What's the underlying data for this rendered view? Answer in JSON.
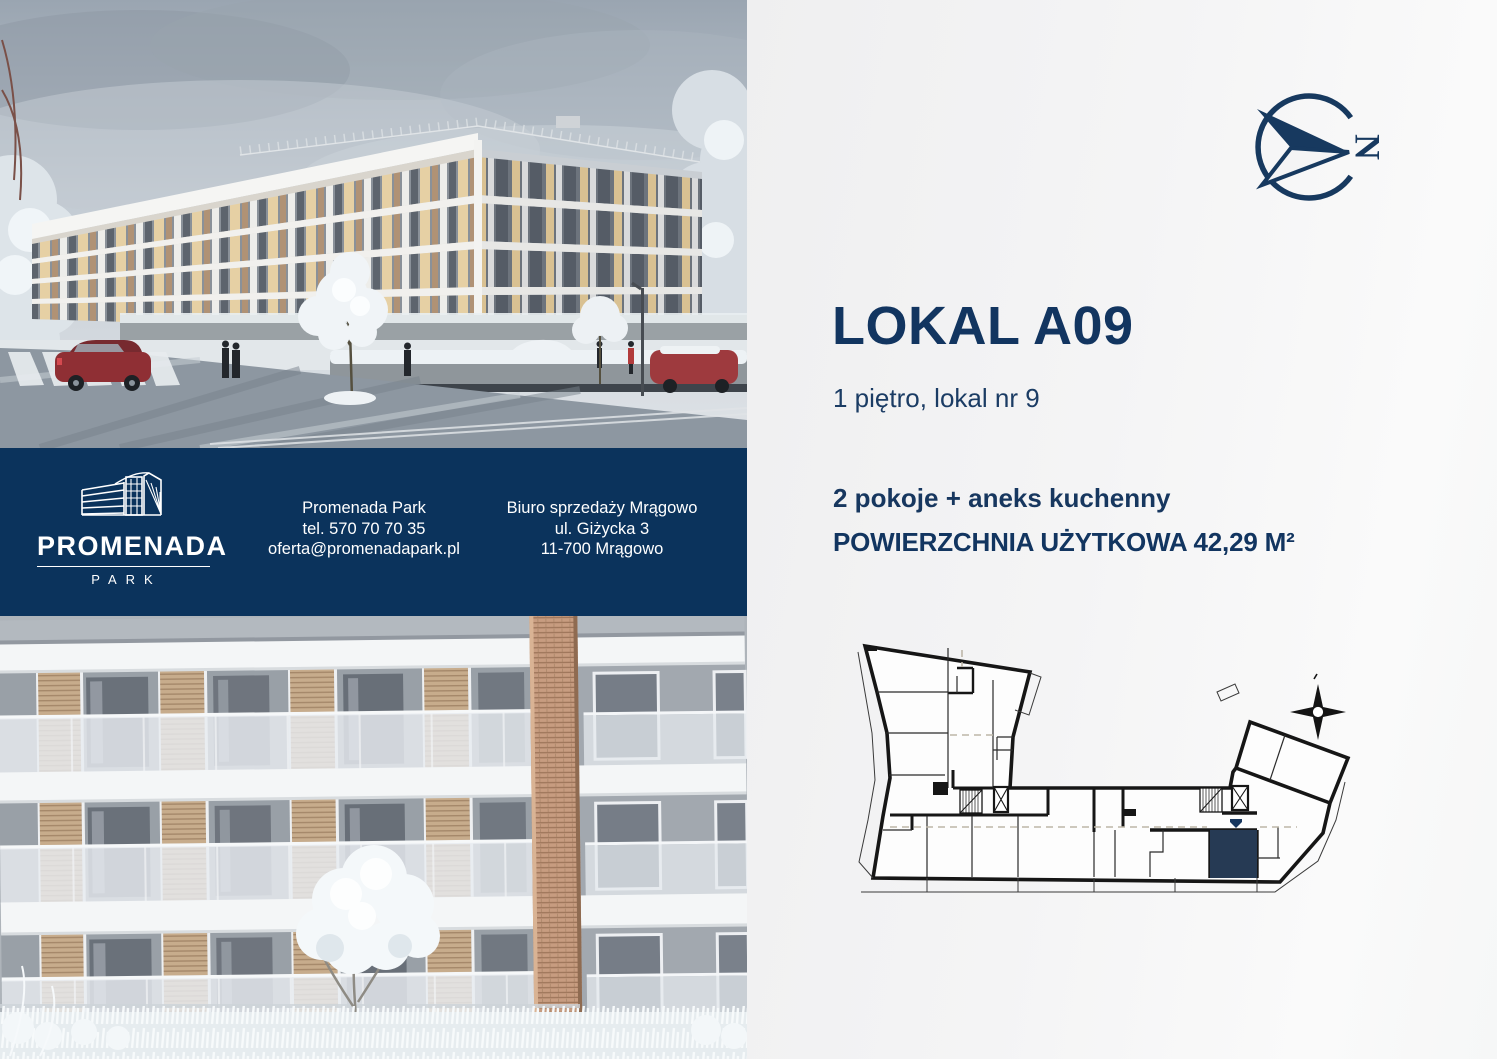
{
  "brand": {
    "logo_name": "PROMENADA",
    "logo_sub": "PARK"
  },
  "contact": {
    "company": "Promenada Park",
    "phone": "tel. 570 70 70 35",
    "email": "oferta@promenadapark.pl",
    "office_name": "Biuro sprzedaży Mrągowo",
    "office_street": "ul. Giżycka 3",
    "office_city": "11-700 Mrągowo"
  },
  "unit": {
    "title": "LOKAL A09",
    "floor_info": "1 piętro, lokal nr 9",
    "layout_info": "2 pokoje + aneks kuchenny",
    "area_info": "POWIERZCHNIA UŻYTKOWA 42,29 M²"
  },
  "compass": {
    "north_letter": "N"
  },
  "colors": {
    "navy_band": "#0b335c",
    "navy_text": "#123560",
    "unit_highlight": "#263a54"
  }
}
